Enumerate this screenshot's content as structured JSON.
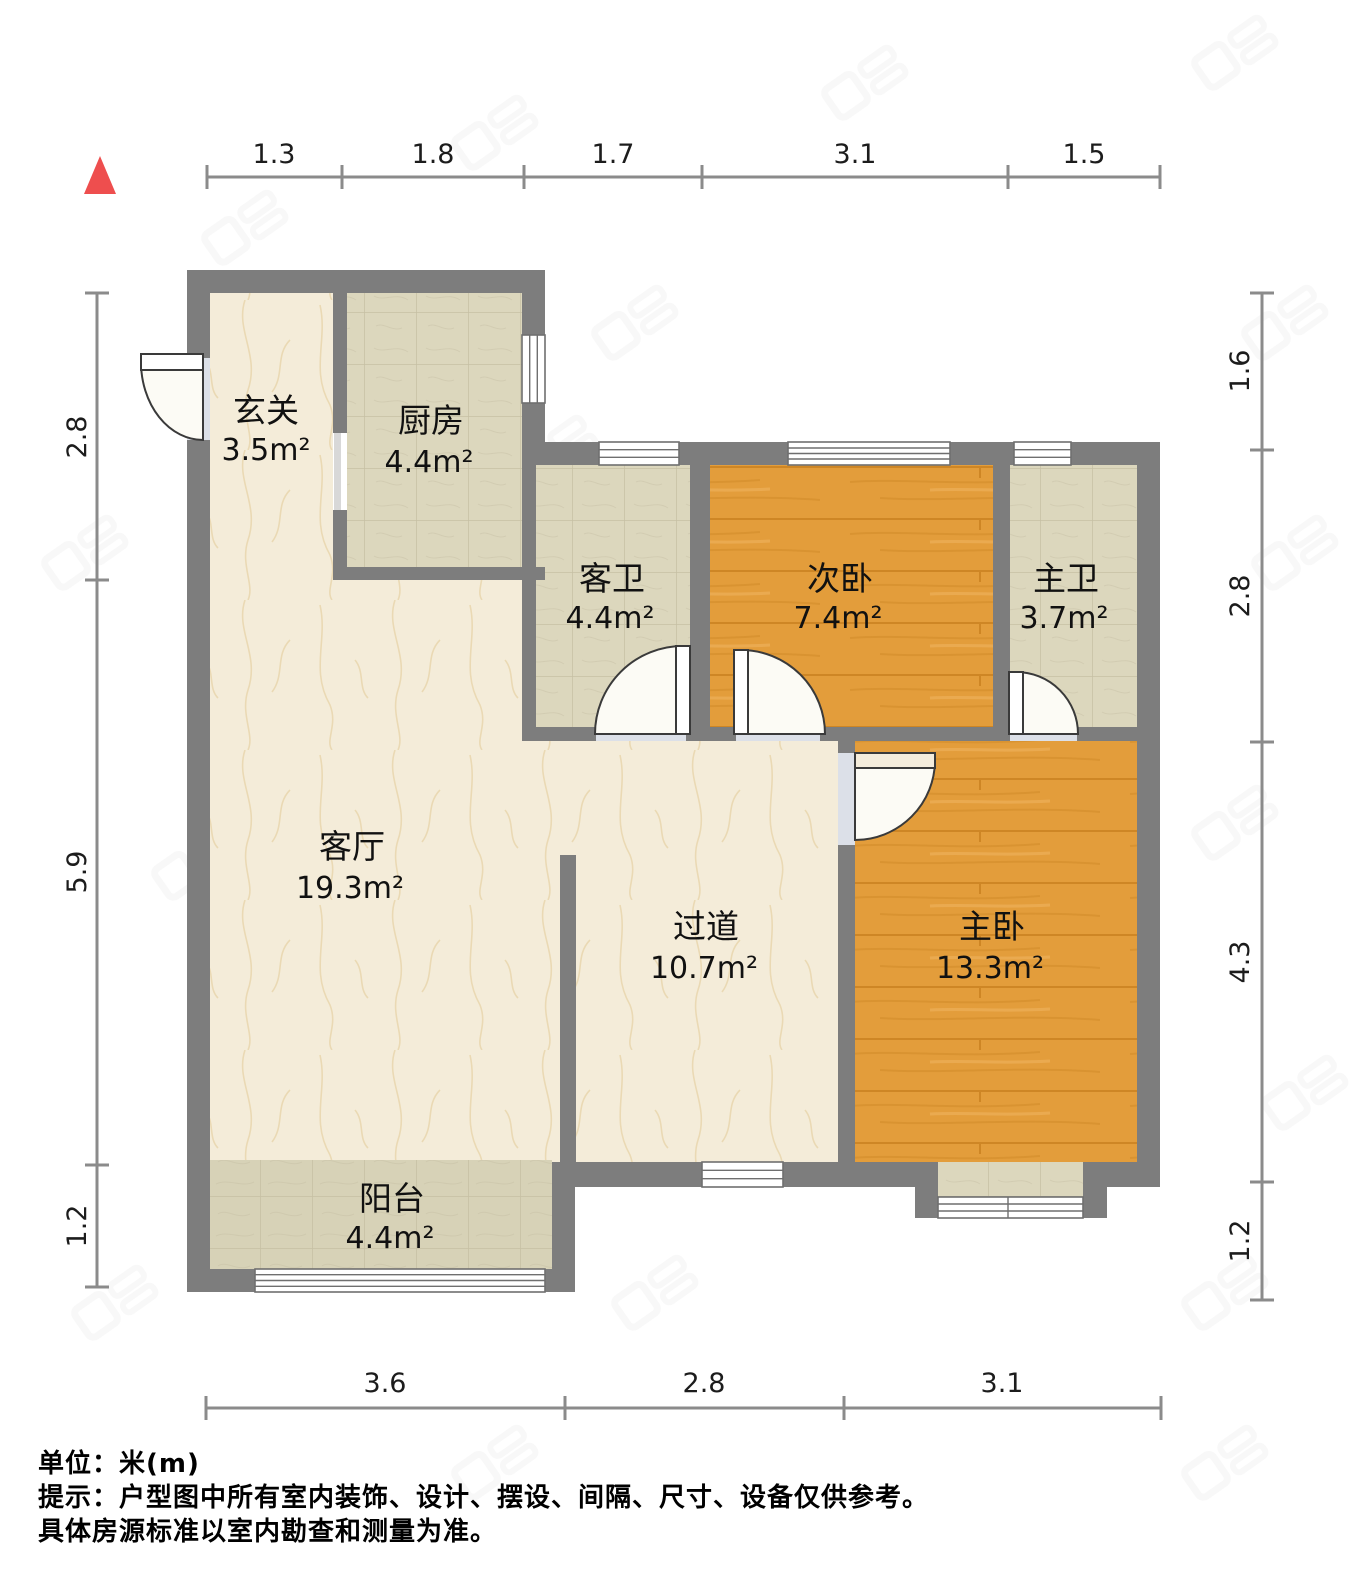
{
  "compass": {
    "shape": "triangle-up"
  },
  "rooms": [
    {
      "id": "foyer",
      "name": "玄关",
      "area": "3.5m²"
    },
    {
      "id": "kitchen",
      "name": "厨房",
      "area": "4.4m²"
    },
    {
      "id": "guest-bath",
      "name": "客卫",
      "area": "4.4m²"
    },
    {
      "id": "second-bedroom",
      "name": "次卧",
      "area": "7.4m²"
    },
    {
      "id": "master-bath",
      "name": "主卫",
      "area": "3.7m²"
    },
    {
      "id": "living-room",
      "name": "客厅",
      "area": "19.3m²"
    },
    {
      "id": "corridor",
      "name": "过道",
      "area": "10.7m²"
    },
    {
      "id": "master-bedroom",
      "name": "主卧",
      "area": "13.3m²"
    },
    {
      "id": "balcony",
      "name": "阳台",
      "area": "4.4m²"
    }
  ],
  "dimensions": {
    "top": [
      "1.3",
      "1.8",
      "1.7",
      "3.1",
      "1.5"
    ],
    "left": [
      "2.8",
      "5.9",
      "1.2"
    ],
    "right": [
      "1.6",
      "2.8",
      "4.3",
      "1.2"
    ],
    "bottom": [
      "3.6",
      "2.8",
      "3.1"
    ]
  },
  "footer": {
    "line1": "单位：米(m)",
    "line2": "提示：户型图中所有室内装饰、设计、摆设、间隔、尺寸、设备仅供参考。",
    "line3": "具体房源标准以室内勘查和测量为准。"
  },
  "colors": {
    "wall": "#7d7d7d",
    "marble": "#f4ecd9",
    "marbleVein": "#e5cfa0",
    "tile": "#dcd7bd",
    "tileLine": "#c6c0a4",
    "balconyTile": "#d7d2b7",
    "wood": "#e39d3b",
    "woodDark": "#c9811f",
    "woodGrain": "#d28c29",
    "windowFill": "#ffffff",
    "windowLine": "#6f6f6f",
    "doorStroke": "#3a3a3a",
    "threshold": "#dce0e8",
    "dimLine": "#8b8b8b",
    "text": "#1c1c1c",
    "north": "#ee4e4e",
    "watermark": "#9a9a9a"
  }
}
